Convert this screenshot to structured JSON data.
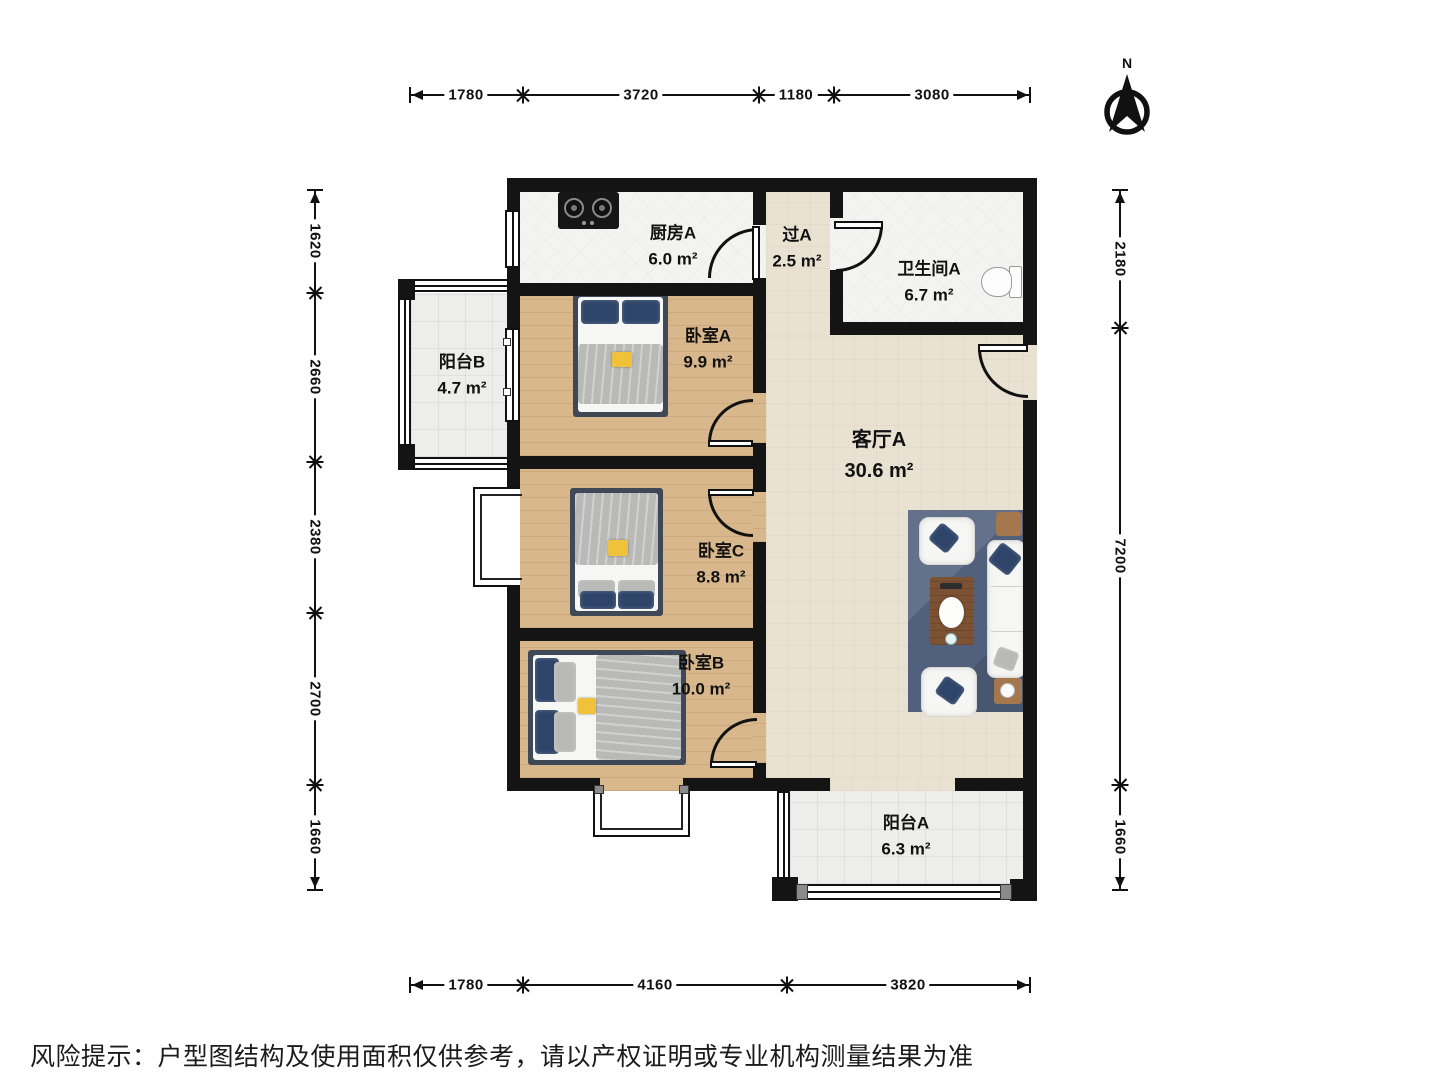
{
  "north": {
    "label": "N"
  },
  "rooms": {
    "kitchen": {
      "name": "厨房A",
      "area": "6.0 m²"
    },
    "passage": {
      "name": "过A",
      "area": "2.5 m²"
    },
    "bathroom": {
      "name": "卫生间A",
      "area": "6.7 m²"
    },
    "balcony_b": {
      "name": "阳台B",
      "area": "4.7 m²"
    },
    "bedroom_a": {
      "name": "卧室A",
      "area": "9.9 m²"
    },
    "living": {
      "name": "客厅A",
      "area": "30.6 m²"
    },
    "bedroom_c": {
      "name": "卧室C",
      "area": "8.8 m²"
    },
    "bedroom_b": {
      "name": "卧室B",
      "area": "10.0 m²"
    },
    "balcony_a": {
      "name": "阳台A",
      "area": "6.3 m²"
    }
  },
  "dimensions": {
    "top": [
      "1780",
      "3720",
      "1180",
      "3080"
    ],
    "bottom": [
      "1780",
      "4160",
      "3820"
    ],
    "left": [
      "1620",
      "2660",
      "2380",
      "2700",
      "1660"
    ],
    "right": [
      "2180",
      "7200",
      "1660"
    ]
  },
  "disclaimer": "风险提示：户型图结构及使用面积仅供参考，请以产权证明或专业机构测量结果为准",
  "colors": {
    "wall": "#141414",
    "wood": "#d9b78c",
    "living": "#e9e2d3",
    "tile": "#f3f3f1",
    "balcony": "#ededec",
    "bed_frame": "#3f4856",
    "pillow_navy": "#2e4468",
    "blanket_gray": "#b9b9b7",
    "rug": "#51617d",
    "table_brown": "#7d5233",
    "tag_yellow": "#f0c23c"
  }
}
